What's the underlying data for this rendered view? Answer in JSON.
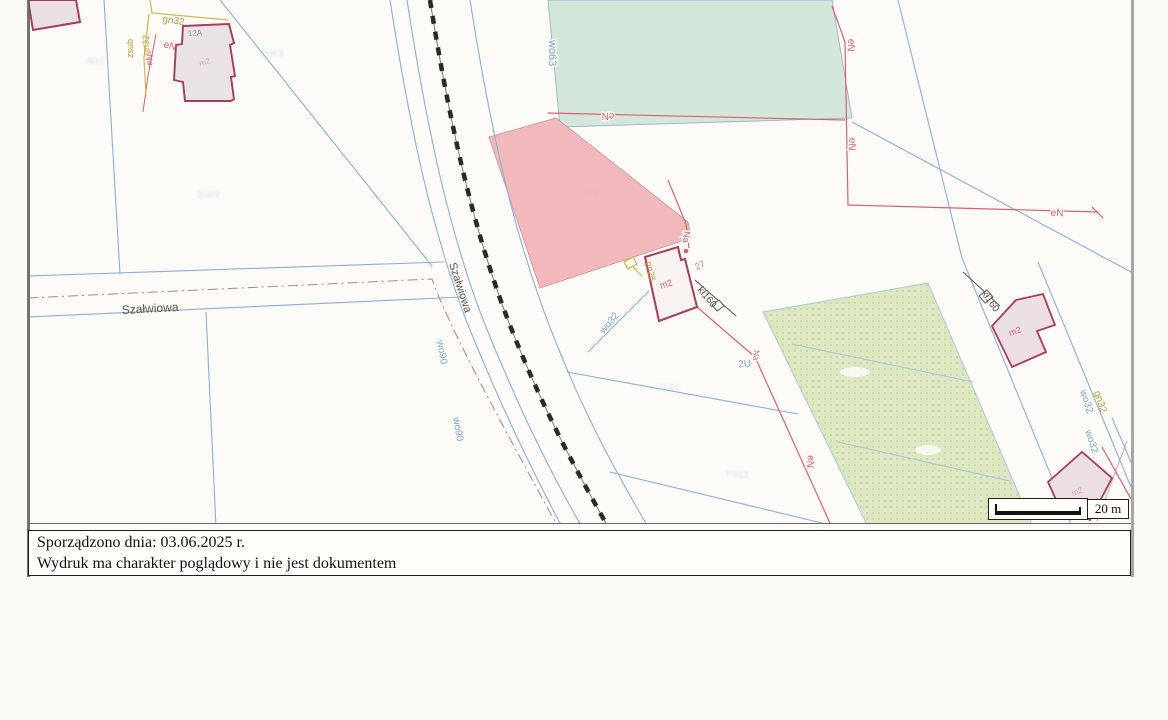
{
  "footer": {
    "line1": "Sporządzono dnia: 03.06.2025 r.",
    "line2": "Wydruk ma charakter poglądowy i nie jest dokumentem"
  },
  "scalebar": {
    "label": "20 m"
  },
  "colors": {
    "blue": "#7da3c8",
    "red": "#d9616d",
    "olive": "#b5a03e",
    "gray": "#97948f",
    "dark": "#55524e",
    "faint": "#a9c2d8",
    "building_border": "#a63d5a",
    "pink_area": "#f2b9bd",
    "mint_area": "#d2e6da",
    "olive_area": "#dde7c2"
  },
  "map": {
    "street_name": "Szałwiowa",
    "labels": [
      {
        "name": "label-gn32-top",
        "text": "gn32",
        "x": 162,
        "y": 22,
        "rot": 8,
        "color": "olive",
        "size": 10
      },
      {
        "name": "label-zsub-vertical",
        "text": "zsub",
        "x": 133,
        "y": 58,
        "rot": -90,
        "color": "olive",
        "size": 9
      },
      {
        "name": "label-gn32-vertical",
        "text": "gn32",
        "x": 149,
        "y": 55,
        "rot": -90,
        "color": "olive",
        "size": 9
      },
      {
        "name": "label-en-topleft-1",
        "text": "eN",
        "x": 163,
        "y": 47,
        "rot": 15,
        "color": "red",
        "size": 10
      },
      {
        "name": "label-en-topleft-2",
        "text": "eN",
        "x": 152,
        "y": 66,
        "rot": -85,
        "color": "red",
        "size": 9
      },
      {
        "name": "label-house-number-12a",
        "text": "12A",
        "x": 188,
        "y": 36,
        "rot": -3,
        "color": "gray",
        "size": 8
      },
      {
        "name": "label-m2-topleft",
        "text": "m2",
        "x": 200,
        "y": 66,
        "rot": -15,
        "color": "red",
        "size": 8,
        "opacity": 0.45
      },
      {
        "name": "label-wo63",
        "text": "wo63",
        "x": 549,
        "y": 40,
        "rot": 90,
        "color": "blue",
        "size": 11,
        "halo": true
      },
      {
        "name": "label-en-green-bottom",
        "text": "eN",
        "x": 608,
        "y": 113,
        "rot": 180,
        "color": "red",
        "size": 10,
        "halo": true,
        "anchor": "middle"
      },
      {
        "name": "label-en-right-upper",
        "text": "eN",
        "x": 848,
        "y": 45,
        "rot": 95,
        "color": "red",
        "size": 10,
        "halo": true,
        "anchor": "middle"
      },
      {
        "name": "label-en-right-mid",
        "text": "eN",
        "x": 849,
        "y": 144,
        "rot": 95,
        "color": "red",
        "size": 10,
        "halo": true,
        "anchor": "middle"
      },
      {
        "name": "label-en-right-horizontal",
        "text": "eN",
        "x": 1057,
        "y": 216,
        "rot": 2,
        "color": "red",
        "size": 10,
        "halo": true,
        "anchor": "middle"
      },
      {
        "name": "label-na-mid",
        "text": "Na",
        "x": 684,
        "y": 231,
        "rot": 95,
        "color": "red",
        "size": 9,
        "halo": true
      },
      {
        "name": "label-parcel-27",
        "text": "27",
        "x": 701,
        "y": 268,
        "rot": -25,
        "color": "gray",
        "size": 9,
        "anchor": "middle"
      },
      {
        "name": "label-m2-center",
        "text": "m2",
        "x": 667,
        "y": 287,
        "rot": -18,
        "color": "red",
        "size": 9,
        "anchor": "middle"
      },
      {
        "name": "label-kl160-center",
        "text": "kł160",
        "x": 697,
        "y": 290,
        "rot": 50,
        "color": "dark",
        "size": 10
      },
      {
        "name": "label-wo32-service",
        "text": "wo32",
        "x": 604,
        "y": 334,
        "rot": -50,
        "color": "blue",
        "size": 10
      },
      {
        "name": "label-gn25",
        "text": "gn25",
        "x": 646,
        "y": 262,
        "rot": 80,
        "color": "olive",
        "size": 9
      },
      {
        "name": "label-street-horizontal",
        "text": "Szałwiowa",
        "x": 122,
        "y": 314,
        "rot": -3,
        "color": "dark",
        "size": 12
      },
      {
        "name": "label-street-diagonal",
        "text": "Szałwiowa",
        "x": 449,
        "y": 264,
        "rot": 72,
        "color": "dark",
        "size": 11
      },
      {
        "name": "label-wo90-upper",
        "text": "wo90",
        "x": 437,
        "y": 341,
        "rot": 80,
        "color": "blue",
        "size": 10
      },
      {
        "name": "label-wo90-lower",
        "text": "wo90",
        "x": 453,
        "y": 418,
        "rot": 80,
        "color": "blue",
        "size": 10
      },
      {
        "name": "label-2u",
        "text": "2U",
        "x": 745,
        "y": 367,
        "rot": -5,
        "color": "blue",
        "size": 10,
        "anchor": "middle"
      },
      {
        "name": "label-na-lower",
        "text": "Na",
        "x": 754,
        "y": 350,
        "rot": 95,
        "color": "red",
        "size": 8,
        "halo": true
      },
      {
        "name": "label-en-lower",
        "text": "eN",
        "x": 808,
        "y": 455,
        "rot": 95,
        "color": "red",
        "size": 10,
        "halo": true
      },
      {
        "name": "label-kl160-right",
        "text": "kł160",
        "x": 981,
        "y": 293,
        "rot": 55,
        "color": "dark",
        "size": 10
      },
      {
        "name": "label-m2-right1",
        "text": "m2",
        "x": 1016,
        "y": 334,
        "rot": -20,
        "color": "red",
        "size": 9,
        "anchor": "middle"
      },
      {
        "name": "label-wo32-road",
        "text": "wo32",
        "x": 1080,
        "y": 391,
        "rot": 72,
        "color": "blue",
        "size": 10
      },
      {
        "name": "label-gn32-road",
        "text": "gn32",
        "x": 1094,
        "y": 392,
        "rot": 72,
        "color": "olive",
        "size": 10
      },
      {
        "name": "label-wo32-right2",
        "text": "wo32",
        "x": 1085,
        "y": 431,
        "rot": 72,
        "color": "blue",
        "size": 10
      },
      {
        "name": "label-m2-right2",
        "text": "m2",
        "x": 1078,
        "y": 494,
        "rot": -20,
        "color": "red",
        "size": 8,
        "opacity": 0.55,
        "anchor": "middle"
      },
      {
        "name": "faint-parcel-label",
        "text": "60/2",
        "x": 96,
        "y": 64,
        "rot": 0,
        "color": "faint",
        "size": 9,
        "blur": true,
        "opacity": 0.5,
        "anchor": "middle"
      },
      {
        "name": "faint-parcel-label",
        "text": "204/3",
        "x": 272,
        "y": 56,
        "rot": 0,
        "color": "faint",
        "size": 9,
        "blur": true,
        "opacity": 0.5,
        "anchor": "middle"
      },
      {
        "name": "faint-parcel-label",
        "text": "204/4",
        "x": 208,
        "y": 198,
        "rot": 0,
        "color": "faint",
        "size": 9,
        "blur": true,
        "opacity": 0.5,
        "anchor": "middle"
      },
      {
        "name": "faint-parcel-label",
        "text": "77/4",
        "x": 591,
        "y": 197,
        "rot": 0,
        "color": "faint",
        "size": 9,
        "blur": true,
        "opacity": 0.5,
        "anchor": "middle"
      },
      {
        "name": "faint-parcel-label",
        "text": "77/10",
        "x": 668,
        "y": 391,
        "rot": 0,
        "color": "faint",
        "size": 9,
        "blur": true,
        "opacity": 0.5,
        "anchor": "middle"
      },
      {
        "name": "faint-parcel-label",
        "text": "77/12",
        "x": 737,
        "y": 478,
        "rot": 0,
        "color": "faint",
        "size": 9,
        "blur": true,
        "opacity": 0.5,
        "anchor": "middle"
      }
    ]
  }
}
